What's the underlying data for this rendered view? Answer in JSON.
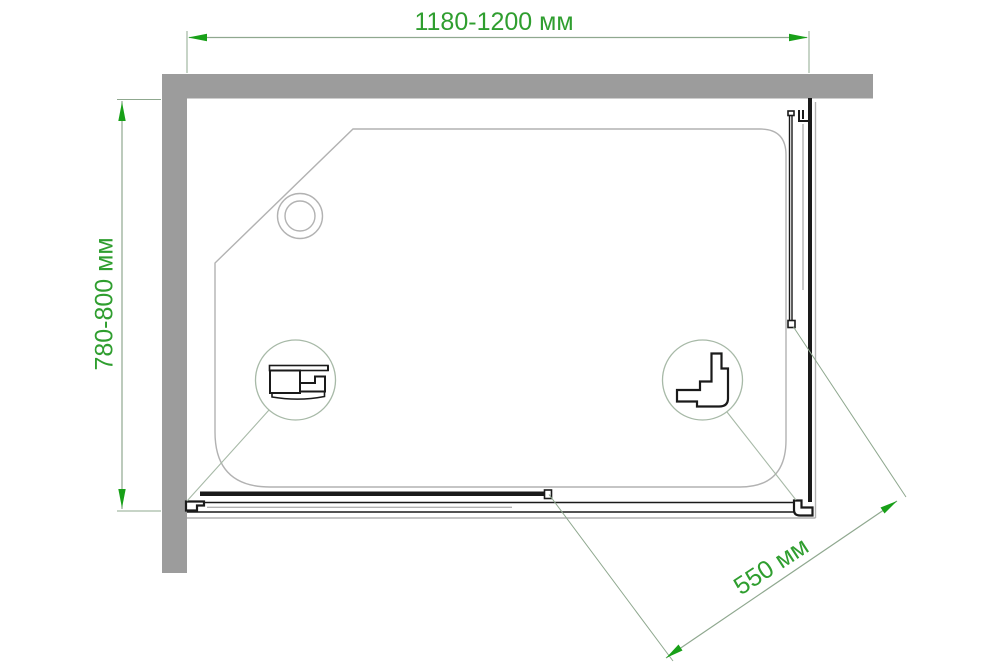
{
  "drawing": {
    "type": "shower-enclosure-top-view-technical-drawing",
    "dimensions": {
      "width": {
        "label": "1180-1200 мм"
      },
      "depth": {
        "label": "780-800 мм"
      },
      "door": {
        "label": "550 мм"
      }
    }
  },
  "colors": {
    "ink": "#1a1a1a",
    "wall": "#9c9c9c",
    "tray-line": "#b2b2b2",
    "dim-line": "#8fa88f",
    "dim-arrow": "#18a018",
    "dim-text": "#2f9e2f",
    "callout-line": "#a7b9a7",
    "bg": "#ffffff"
  }
}
